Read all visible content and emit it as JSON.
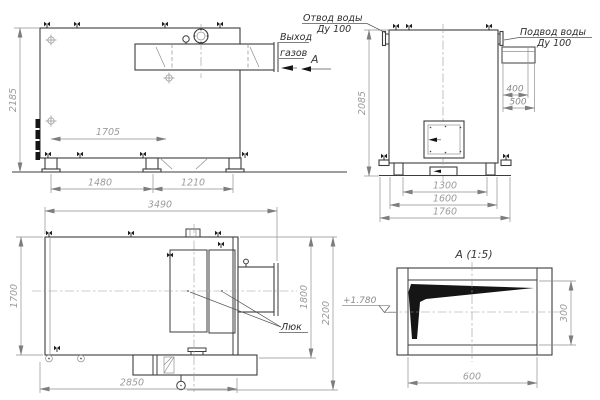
{
  "drawing_labels": {
    "water_outlet_l1": "Отвод воды",
    "water_outlet_l2": "Ду 100",
    "water_inlet_l1": "Подвод воды",
    "water_inlet_l2": "Ду 100",
    "gas_outlet_l1": "Выход",
    "gas_outlet_l2": "газов",
    "section_letter": "А",
    "hatch_label": "Люк",
    "detail_title": "А (1:5)",
    "elevation_mark": "+1.780"
  },
  "dimensions": {
    "side_view": {
      "overall_height": "2185",
      "support_span": "1705",
      "base_front": "1480",
      "base_rear": "1210"
    },
    "front_view": {
      "overall_height": "2085",
      "pipe_offset_1": "400",
      "pipe_offset_2": "500",
      "base_inner": "1300",
      "base_middle": "1600",
      "base_outer": "1760"
    },
    "plan_view": {
      "overall_length": "3490",
      "body_width": "1700",
      "width_right_1": "1800",
      "width_right_2": "2200",
      "bottom_length": "2850"
    },
    "detail_a": {
      "height": "300",
      "width": "600"
    }
  },
  "icons": {
    "valve": "flag-valve",
    "lifting_point": "crosshair-mark",
    "handwheel": "circle-dot"
  },
  "colors": {
    "background": "#ffffff",
    "main_line": "#3d3d3d",
    "thin_line": "#8f8f8f",
    "dim_text": "#9b9b9b",
    "label_text": "#2e2e2e"
  }
}
